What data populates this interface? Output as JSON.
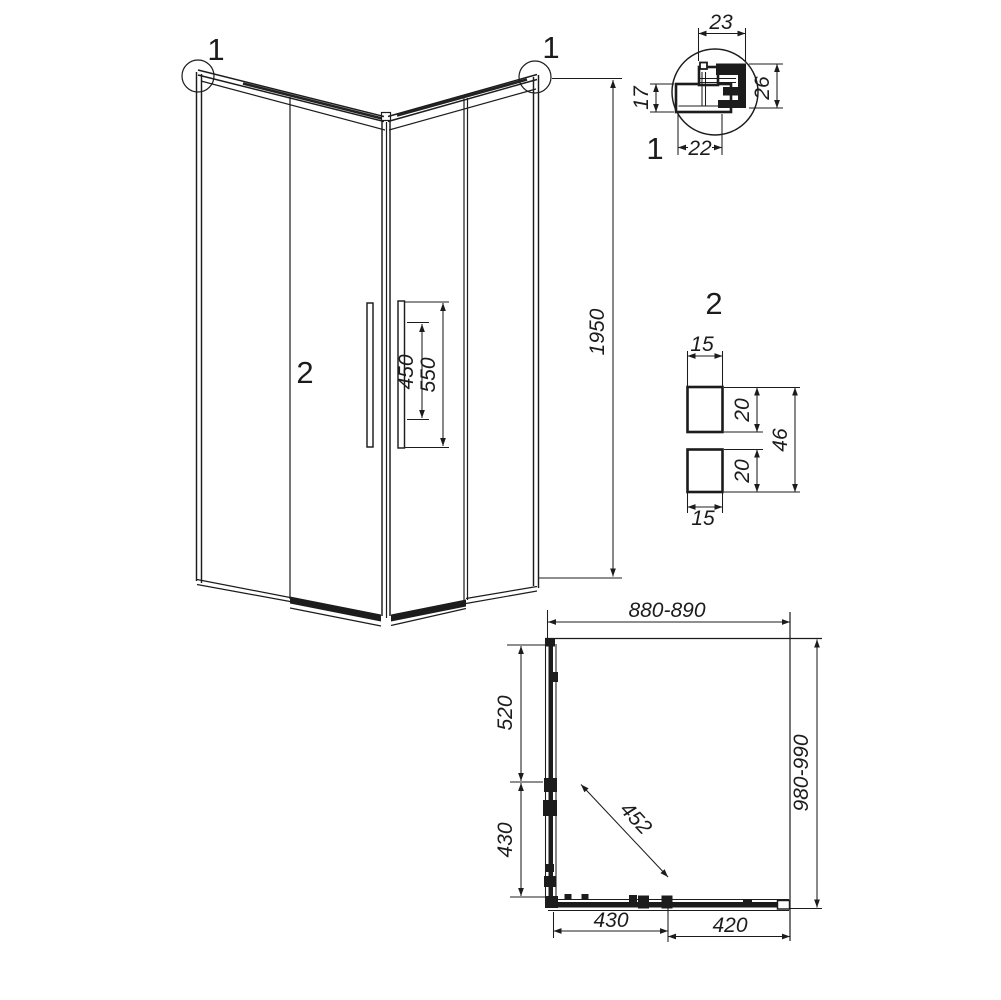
{
  "title": "Corner shower enclosure technical drawing",
  "colors": {
    "line": "#1c1c1c",
    "background": "#ffffff"
  },
  "main_view": {
    "callout_left": "1",
    "callout_right": "1",
    "door_label": "2",
    "height_mm": "1950",
    "handle_inner_mm": "450",
    "handle_outer_mm": "550"
  },
  "detail_1": {
    "label": "1",
    "width_top_mm": "23",
    "depth_right_mm": "26",
    "height_left_mm": "17",
    "width_bottom_mm": "22"
  },
  "detail_2": {
    "label": "2",
    "width_top_mm": "15",
    "upper_profile_mm": "20",
    "lower_profile_mm": "20",
    "total_mm": "46",
    "width_bottom_mm": "15"
  },
  "plan_view": {
    "width_mm": "880-890",
    "depth_mm": "980-990",
    "left_upper_mm": "520",
    "left_lower_mm": "430",
    "diagonal_entry_mm": "452",
    "bottom_left_mm": "430",
    "bottom_right_mm": "420"
  }
}
